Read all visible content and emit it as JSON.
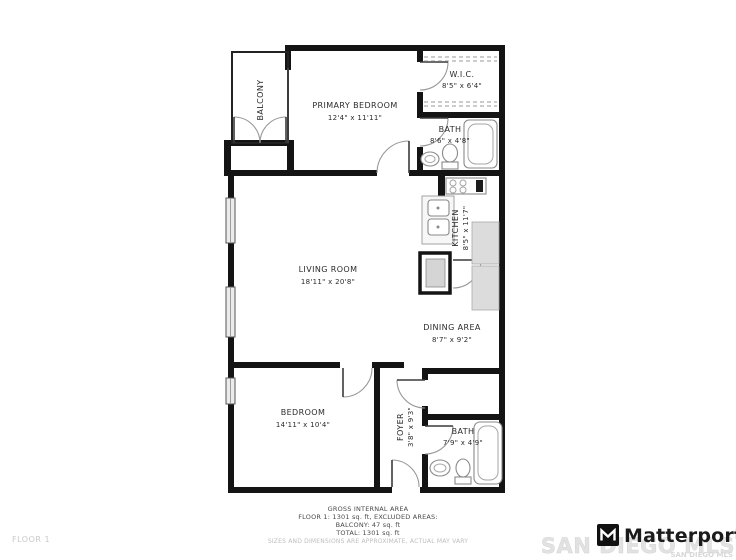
{
  "floor_plan": {
    "rooms": [
      {
        "id": "primary-bedroom",
        "name": "PRIMARY BEDROOM",
        "dims": "12'4\" x 11'11\""
      },
      {
        "id": "wic",
        "name": "W.I.C.",
        "dims": "8'5\" x 6'4\""
      },
      {
        "id": "bath-upper",
        "name": "BATH",
        "dims": "8'6\" x 4'8\""
      },
      {
        "id": "kitchen",
        "name": "KITCHEN",
        "dims": "8'5\" x 11'7\""
      },
      {
        "id": "living-room",
        "name": "LIVING ROOM",
        "dims": "18'11\" x 20'8\""
      },
      {
        "id": "dining-area",
        "name": "DINING AREA",
        "dims": "8'7\" x 9'2\""
      },
      {
        "id": "bedroom",
        "name": "BEDROOM",
        "dims": "14'11\" x 10'4\""
      },
      {
        "id": "foyer",
        "name": "FOYER",
        "dims": "3'8\" x 9'3\""
      },
      {
        "id": "bath-lower",
        "name": "BATH",
        "dims": "7'9\" x 4'9\""
      },
      {
        "id": "balcony",
        "name": "BALCONY",
        "dims": ""
      }
    ]
  },
  "footer": {
    "area_title": "GROSS INTERNAL AREA",
    "line1": "FLOOR 1: 1301 sq. ft, EXCLUDED AREAS:",
    "line2": "BALCONY: 47 sq. ft",
    "line3": "TOTAL: 1301 sq. ft",
    "disclaimer": "SIZES AND DIMENSIONS ARE APPROXIMATE, ACTUAL MAY VARY",
    "floor_label": "FLOOR 1"
  },
  "branding": {
    "logo_text": "Matterport",
    "watermark": "SAN DIEGO MLS",
    "watermark_small": "SAN DIEGO MLS"
  },
  "colors": {
    "wall": "#141414",
    "counter": "#dcdcdc",
    "window": "#ececec",
    "watermark": "#e2e2e2"
  }
}
